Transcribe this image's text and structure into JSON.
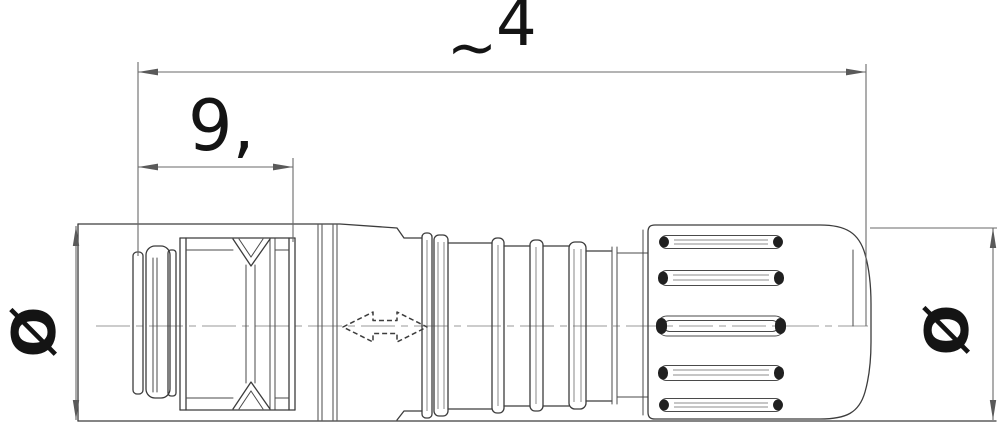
{
  "drawing": {
    "description": "connector-technical-drawing",
    "dimensions": {
      "overall_length": {
        "prefix": "~",
        "value": "4"
      },
      "front_length": {
        "value": "9,"
      },
      "front_diameter": {
        "symbol": "Ø"
      },
      "rear_diameter": {
        "symbol": "Ø"
      }
    },
    "icons": {
      "cable_direction": "double-headed-arrow"
    },
    "colors": {
      "background": "#ffffff",
      "object_line": "#3c3c3c",
      "dimension_line": "#6a6a6a",
      "centerline": "#999999",
      "text": "#141414"
    }
  }
}
